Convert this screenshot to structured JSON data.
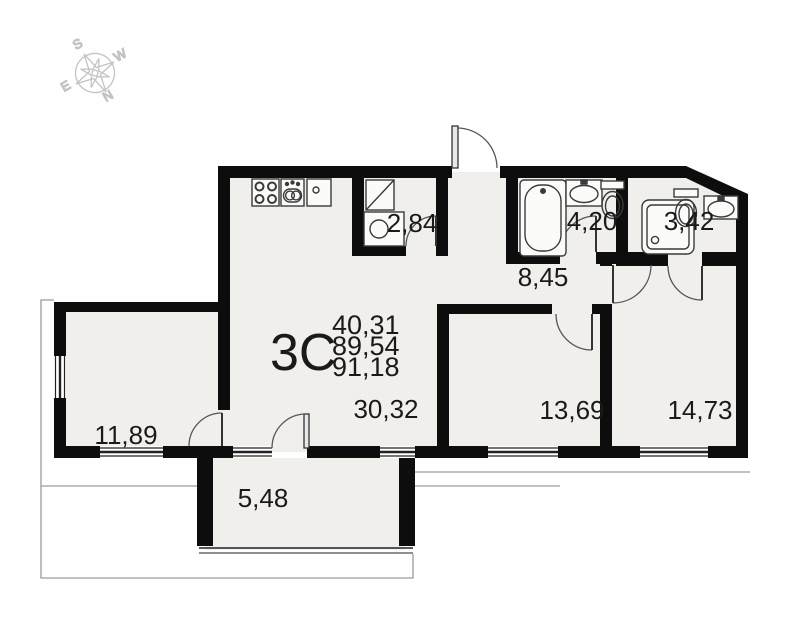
{
  "plan": {
    "type_label": "3C",
    "areas": [
      "40,31",
      "89,54",
      "91,18"
    ],
    "rooms": [
      {
        "name": "kitchen-living-room",
        "area": "30,32"
      },
      {
        "name": "bedroom-left",
        "area": "11,89"
      },
      {
        "name": "bedroom-middle",
        "area": "13,69"
      },
      {
        "name": "bedroom-right",
        "area": "14,73"
      },
      {
        "name": "hallway",
        "area": "8,45"
      },
      {
        "name": "bathroom",
        "area": "4,20"
      },
      {
        "name": "shower-room",
        "area": "3,42"
      },
      {
        "name": "storage",
        "area": "2,84"
      },
      {
        "name": "balcony",
        "area": "5,48"
      }
    ],
    "compass": {
      "north": "N",
      "south": "S",
      "east": "E",
      "west": "W"
    },
    "colors": {
      "wall": "#0d0d0d",
      "room_fill": "#f1efeb",
      "outline": "#9a9a9a",
      "compass": "#c3c3c3",
      "text": "#1a1a1a"
    }
  }
}
